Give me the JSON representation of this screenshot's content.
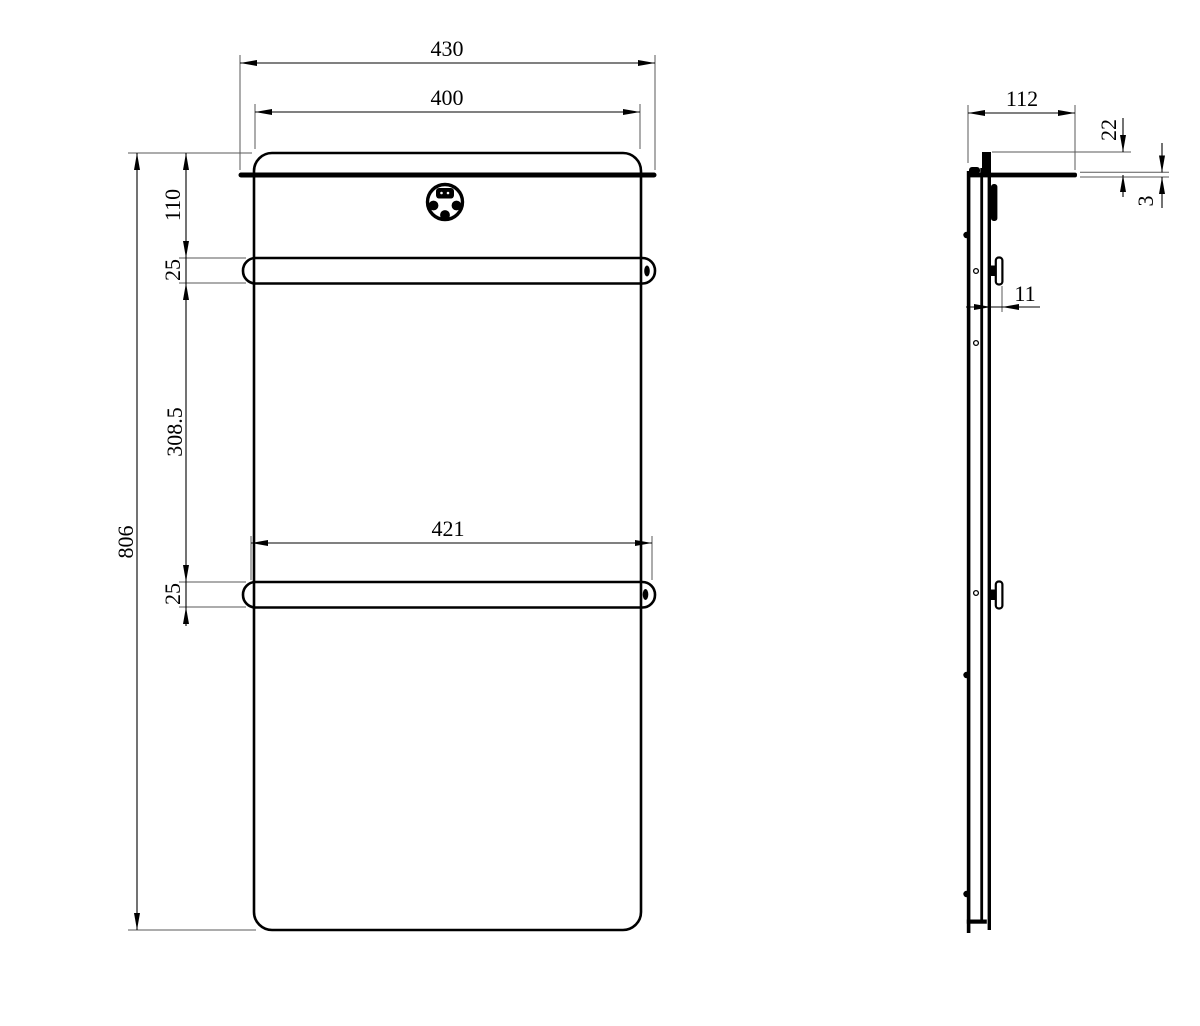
{
  "drawing": {
    "type": "technical-dimension-drawing",
    "subject": "wall-mounted panel towel warmer, front view and side view",
    "colors": {
      "line": "#000000",
      "extension_line": "#5a5a5a",
      "background": "#ffffff"
    }
  },
  "dimensions": {
    "front": {
      "overall_width": "430",
      "panel_width": "400",
      "top_to_bar": "110",
      "top_bar_thickness": "25",
      "bar_spacing": "308.5",
      "bottom_bar_thickness": "25",
      "overall_height": "806",
      "bar_length": "421"
    },
    "side": {
      "depth": "112",
      "top_to_shelf": "22",
      "shelf_thickness": "3",
      "bar_standoff": "11"
    }
  },
  "icons": {
    "control_dial": "control-dial-with-display-and-three-buttons"
  }
}
